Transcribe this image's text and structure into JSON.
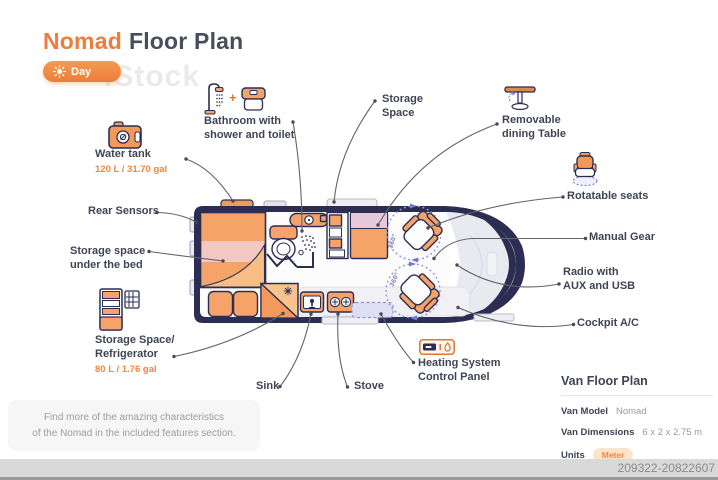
{
  "header": {
    "title_accent": "Nomad",
    "title_rest": "Floor Plan",
    "mode_button": "Day"
  },
  "watermark": {
    "brand": "iStock",
    "asset_id": "209322-20822607"
  },
  "callouts": {
    "water_tank": {
      "label": "Water tank",
      "value": "120 L / 31.70 gal"
    },
    "bathroom": {
      "line1": "Bathroom with",
      "line2": "shower and toilet",
      "joiner": "+"
    },
    "storage_space": {
      "line1": "Storage",
      "line2": "Space"
    },
    "dining_table": {
      "line1": "Removable",
      "line2": "dining Table"
    },
    "rotatable_seats": {
      "label": "Rotatable seats"
    },
    "manual_gear": {
      "label": "Manual Gear"
    },
    "radio": {
      "line1": "Radio with",
      "line2": "AUX and USB"
    },
    "cockpit_ac": {
      "label": "Cockpit A/C"
    },
    "rear_sensors": {
      "label": "Rear Sensors"
    },
    "storage_under_bed": {
      "line1": "Storage space",
      "line2": "under the bed"
    },
    "refrigerator": {
      "line1": "Storage Space/",
      "line2": "Refrigerator",
      "value": "80 L / 1.76 gal"
    },
    "sink": {
      "label": "Sink"
    },
    "stove": {
      "label": "Stove"
    },
    "heating": {
      "line1": "Heating System",
      "line2": "Control Panel"
    }
  },
  "diagram": {
    "rotation_label": "360°"
  },
  "info_panel": {
    "title": "Van Floor Plan",
    "rows": [
      {
        "label": "Van Model",
        "value": "Nomad"
      },
      {
        "label": "Van Dimensions",
        "value": "6 x 2 x 2.75 m"
      },
      {
        "label": "Units",
        "value": "Meter"
      }
    ]
  },
  "note": {
    "line1": "Find more of the amazing characteristics",
    "line2": "of the Nomad in the included features section."
  },
  "colors": {
    "accent": "#EE7C3B",
    "navy": "#2B2E52",
    "furniture": "#F5A368",
    "rotation": "#7478CF"
  }
}
